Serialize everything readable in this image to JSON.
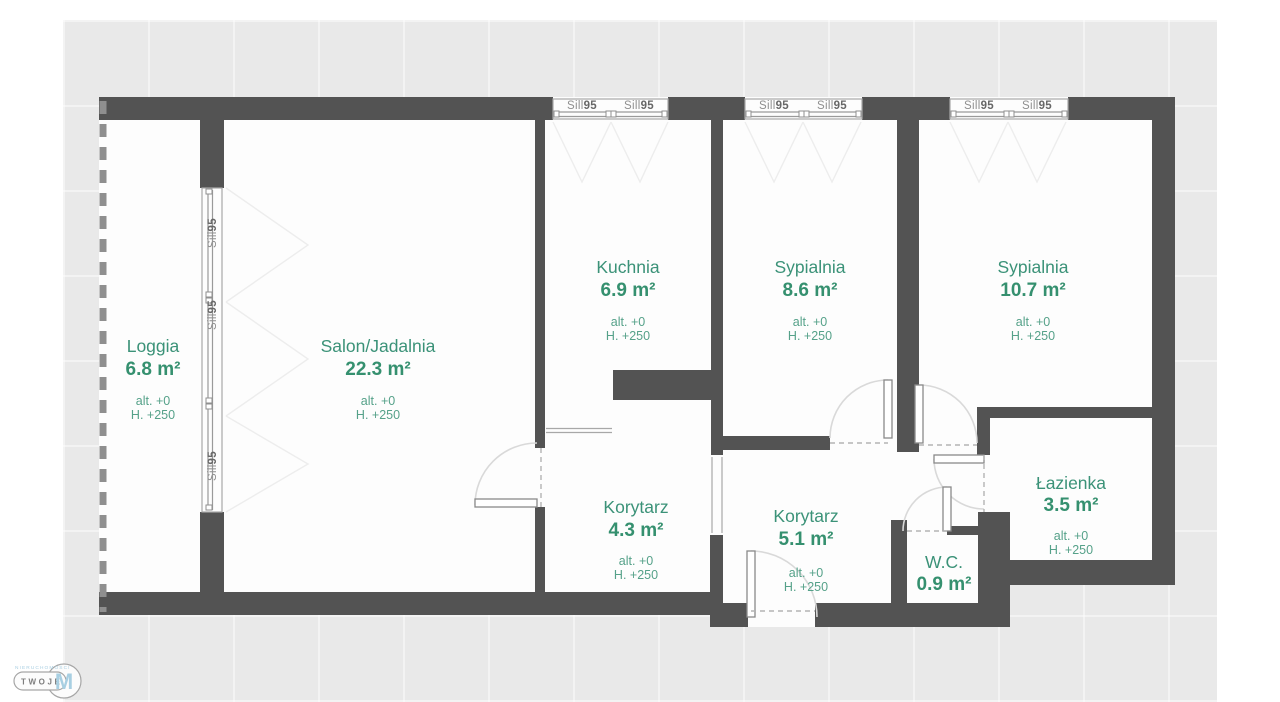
{
  "plan": {
    "type": "apartment-floor-plan",
    "background": "#e9e9e9",
    "wall_color": "#535353",
    "floor_color": "#fdfdfd",
    "accent_green": "#3b9278",
    "logo_blue": "#a8cfe2"
  },
  "rooms": [
    {
      "id": "loggia",
      "name": "Loggia",
      "area": "6.8 m²",
      "alt": "alt. +0",
      "height": "H. +250"
    },
    {
      "id": "salon",
      "name": "Salon/Jadalnia",
      "area": "22.3 m²",
      "alt": "alt. +0",
      "height": "H. +250"
    },
    {
      "id": "kuchnia",
      "name": "Kuchnia",
      "area": "6.9 m²",
      "alt": "alt. +0",
      "height": "H. +250"
    },
    {
      "id": "sypialnia-1",
      "name": "Sypialnia",
      "area": "8.6 m²",
      "alt": "alt. +0",
      "height": "H. +250"
    },
    {
      "id": "sypialnia-2",
      "name": "Sypialnia",
      "area": "10.7 m²",
      "alt": "alt. +0",
      "height": "H. +250"
    },
    {
      "id": "korytarz-1",
      "name": "Korytarz",
      "area": "4.3 m²",
      "alt": "alt. +0",
      "height": "H. +250"
    },
    {
      "id": "korytarz-2",
      "name": "Korytarz",
      "area": "5.1 m²",
      "alt": "alt. +0",
      "height": "H. +250"
    },
    {
      "id": "wc",
      "name": "W.C.",
      "area": "0.9 m²"
    },
    {
      "id": "lazienka",
      "name": "Łazienka",
      "area": "3.5 m²",
      "alt": "alt. +0",
      "height": "H. +250"
    }
  ],
  "window_label": {
    "sill": "Sill",
    "num": "95"
  },
  "logo": {
    "top": "NIERUCHOMOŚCI",
    "main": "TWOJE",
    "letter": "M"
  }
}
